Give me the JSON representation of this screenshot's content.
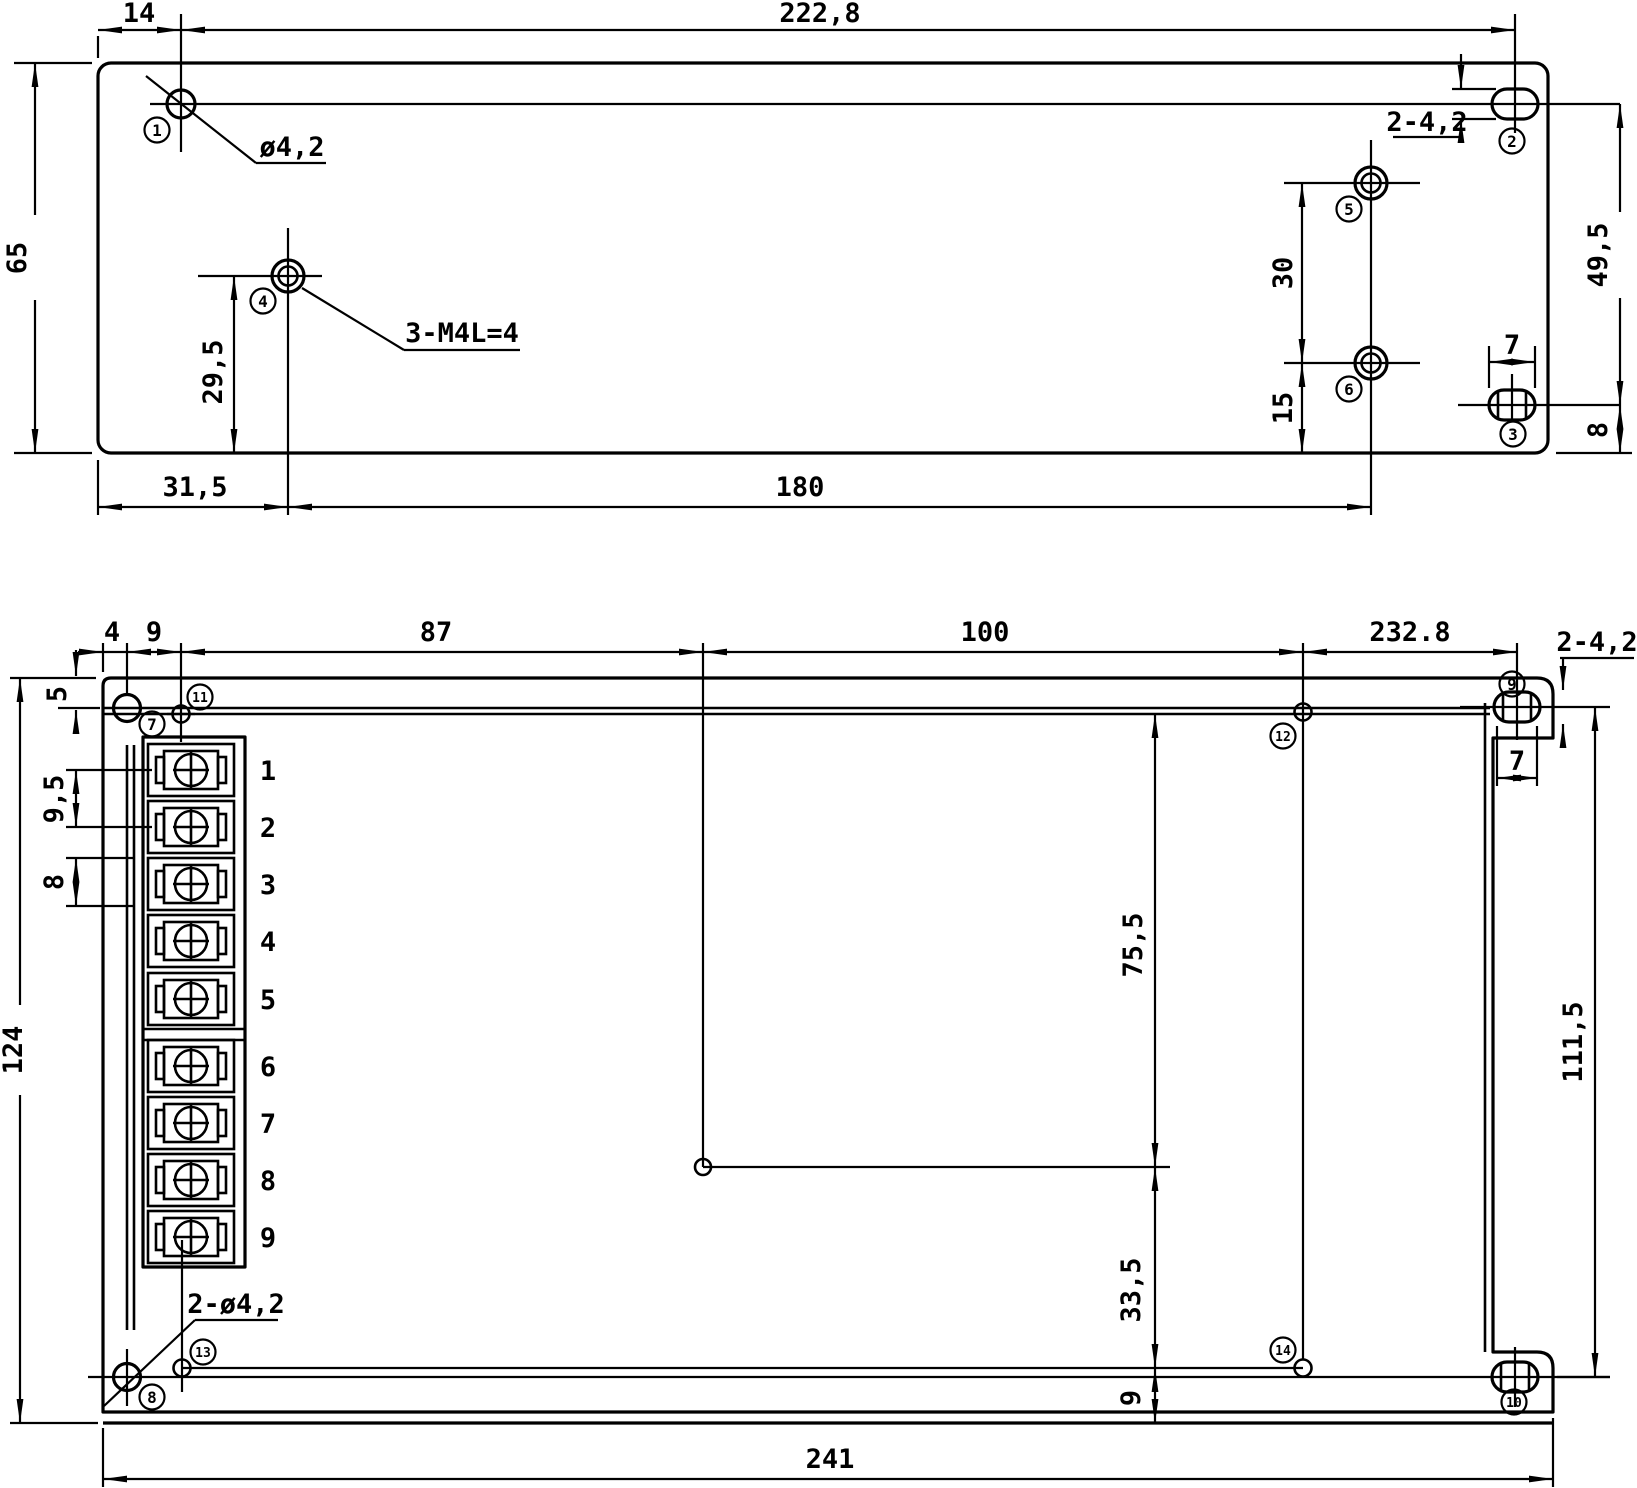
{
  "top_view": {
    "dims": {
      "d14": "14",
      "d2228": "222,8",
      "d65": "65",
      "d295": "29,5",
      "d315": "31,5",
      "d180": "180",
      "d30": "30",
      "d15": "15",
      "d7": "7",
      "d8": "8",
      "d495": "49,5"
    },
    "labels": {
      "hole_dia": "ø4,2",
      "slot": "2-4,2",
      "tapped": "3-M4L=4"
    },
    "markers": {
      "m1": "1",
      "m2": "2",
      "m3": "3",
      "m4": "4",
      "m5": "5",
      "m6": "6"
    }
  },
  "bottom_view": {
    "dims": {
      "d4": "4",
      "d9": "9",
      "d87": "87",
      "d100": "100",
      "d2328": "232.8",
      "d5": "5",
      "d124": "124",
      "d95": "9,5",
      "d8": "8",
      "d755": "75,5",
      "d335": "33,5",
      "d9b": "9",
      "d1115": "111,5",
      "d7b": "7",
      "d241": "241"
    },
    "labels": {
      "slot": "2-4,2",
      "holes": "2-ø4,2"
    },
    "markers": {
      "m7": "7",
      "m8": "8",
      "m9": "9",
      "m10": "10",
      "m11": "11",
      "m12": "12",
      "m13": "13",
      "m14": "14"
    },
    "terminals": [
      "1",
      "2",
      "3",
      "4",
      "5",
      "6",
      "7",
      "8",
      "9"
    ]
  }
}
